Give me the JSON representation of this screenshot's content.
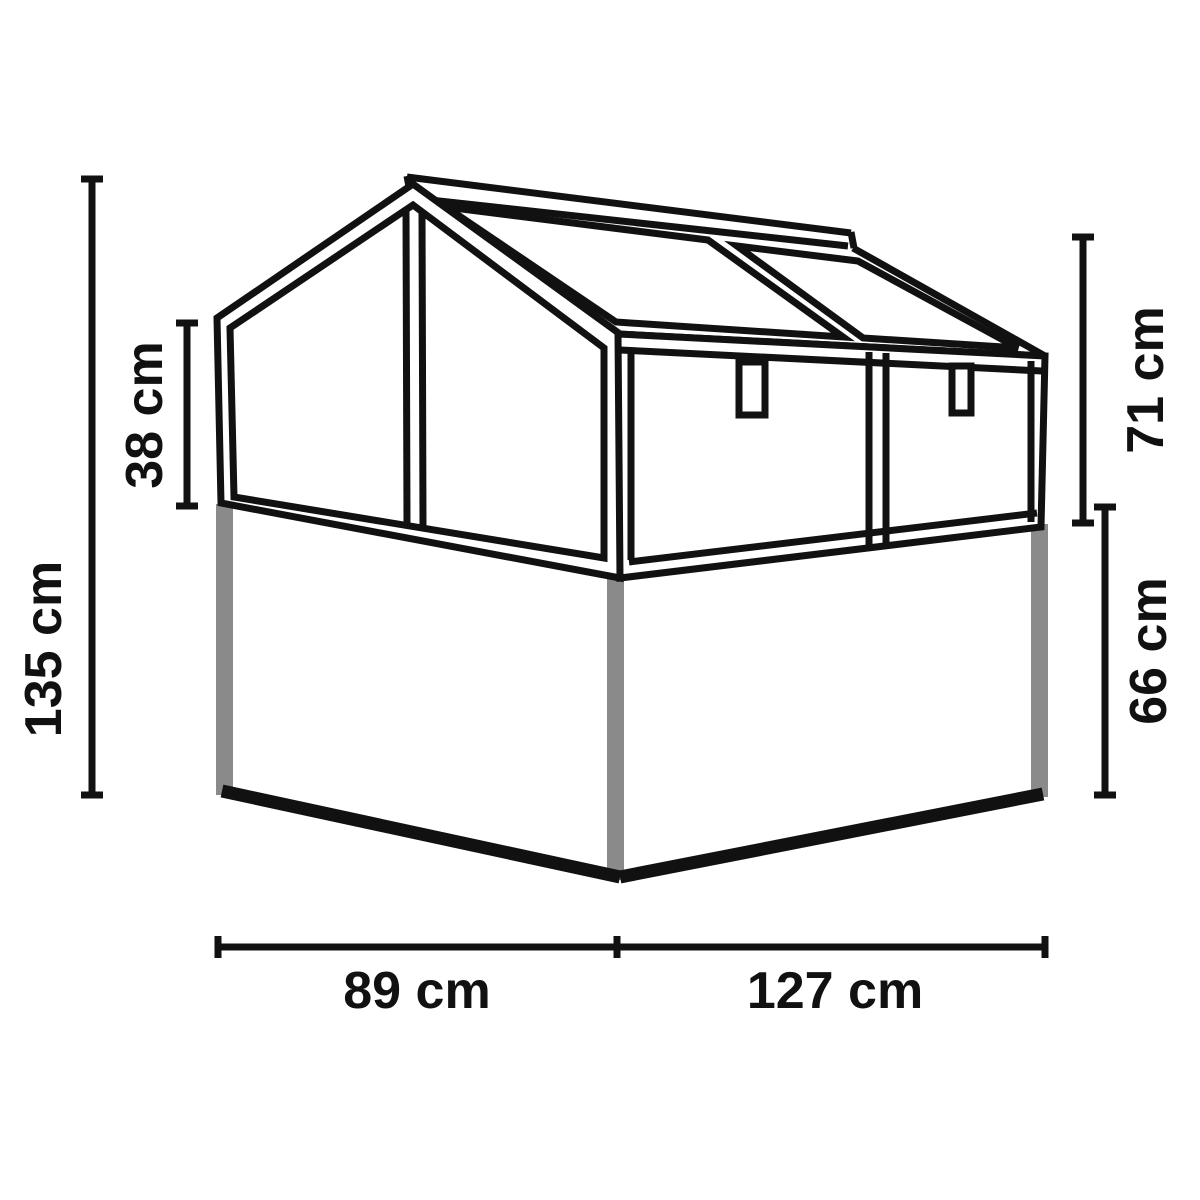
{
  "diagram": {
    "title": "Cold frame greenhouse on raised bed - dimension drawing",
    "unit": "cm",
    "colors": {
      "line": "#111111",
      "post_gray": "#8a8a8a",
      "background": "#ffffff",
      "label_text": "#111111"
    },
    "labels": {
      "total_height": "135 cm",
      "gable_glass_height": "38 cm",
      "top_section_height": "71 cm",
      "base_height": "66 cm",
      "base_depth": "89 cm",
      "base_width": "127 cm"
    }
  }
}
